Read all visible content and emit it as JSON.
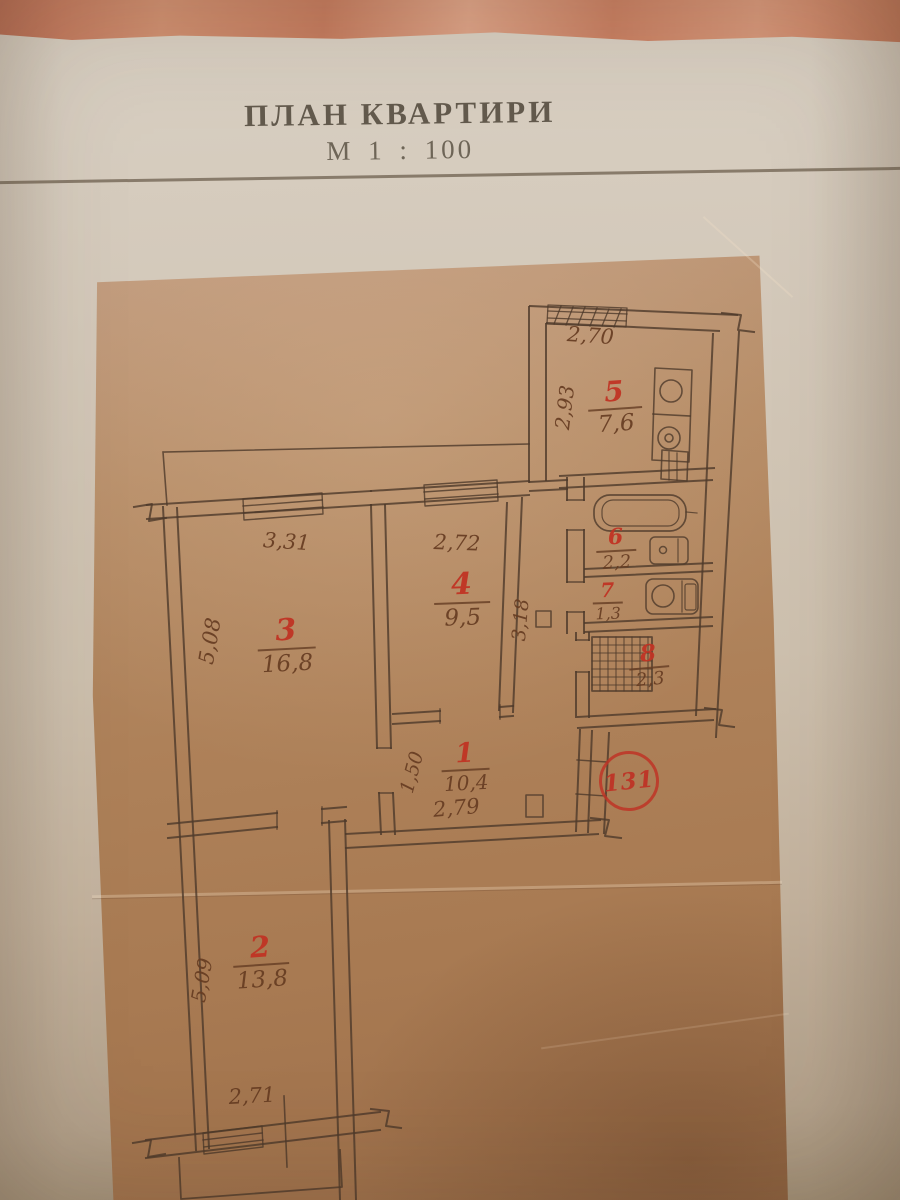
{
  "title": {
    "heading": "ПЛАН КВАРТИРИ",
    "scale": "М 1 : 100"
  },
  "stamp": {
    "number": "131"
  },
  "rooms": [
    {
      "number": "1",
      "area": "10,4"
    },
    {
      "number": "2",
      "area": "13,8"
    },
    {
      "number": "3",
      "area": "16,8"
    },
    {
      "number": "4",
      "area": "9,5"
    },
    {
      "number": "5",
      "area": "7,6"
    },
    {
      "number": "6",
      "area": "2,2"
    },
    {
      "number": "7",
      "area": "1,3"
    },
    {
      "number": "8",
      "area": "2,3"
    }
  ],
  "dims": {
    "kitchen_w": "2,70",
    "kitchen_d": "2,93",
    "room3_w": "3,31",
    "room3_d": "5,08",
    "room4_w": "2,72",
    "room4_d": "3,18",
    "hall_d": "1,50",
    "hall_w": "2,79",
    "room2_d": "5,09",
    "room2_w": "2,71"
  },
  "colors": {
    "ink": "#4e392a",
    "accent_red": "#c0392b",
    "paper": "#cdc0ae",
    "sheet_tan": "#ae8159",
    "fabric": "#c87f62"
  }
}
